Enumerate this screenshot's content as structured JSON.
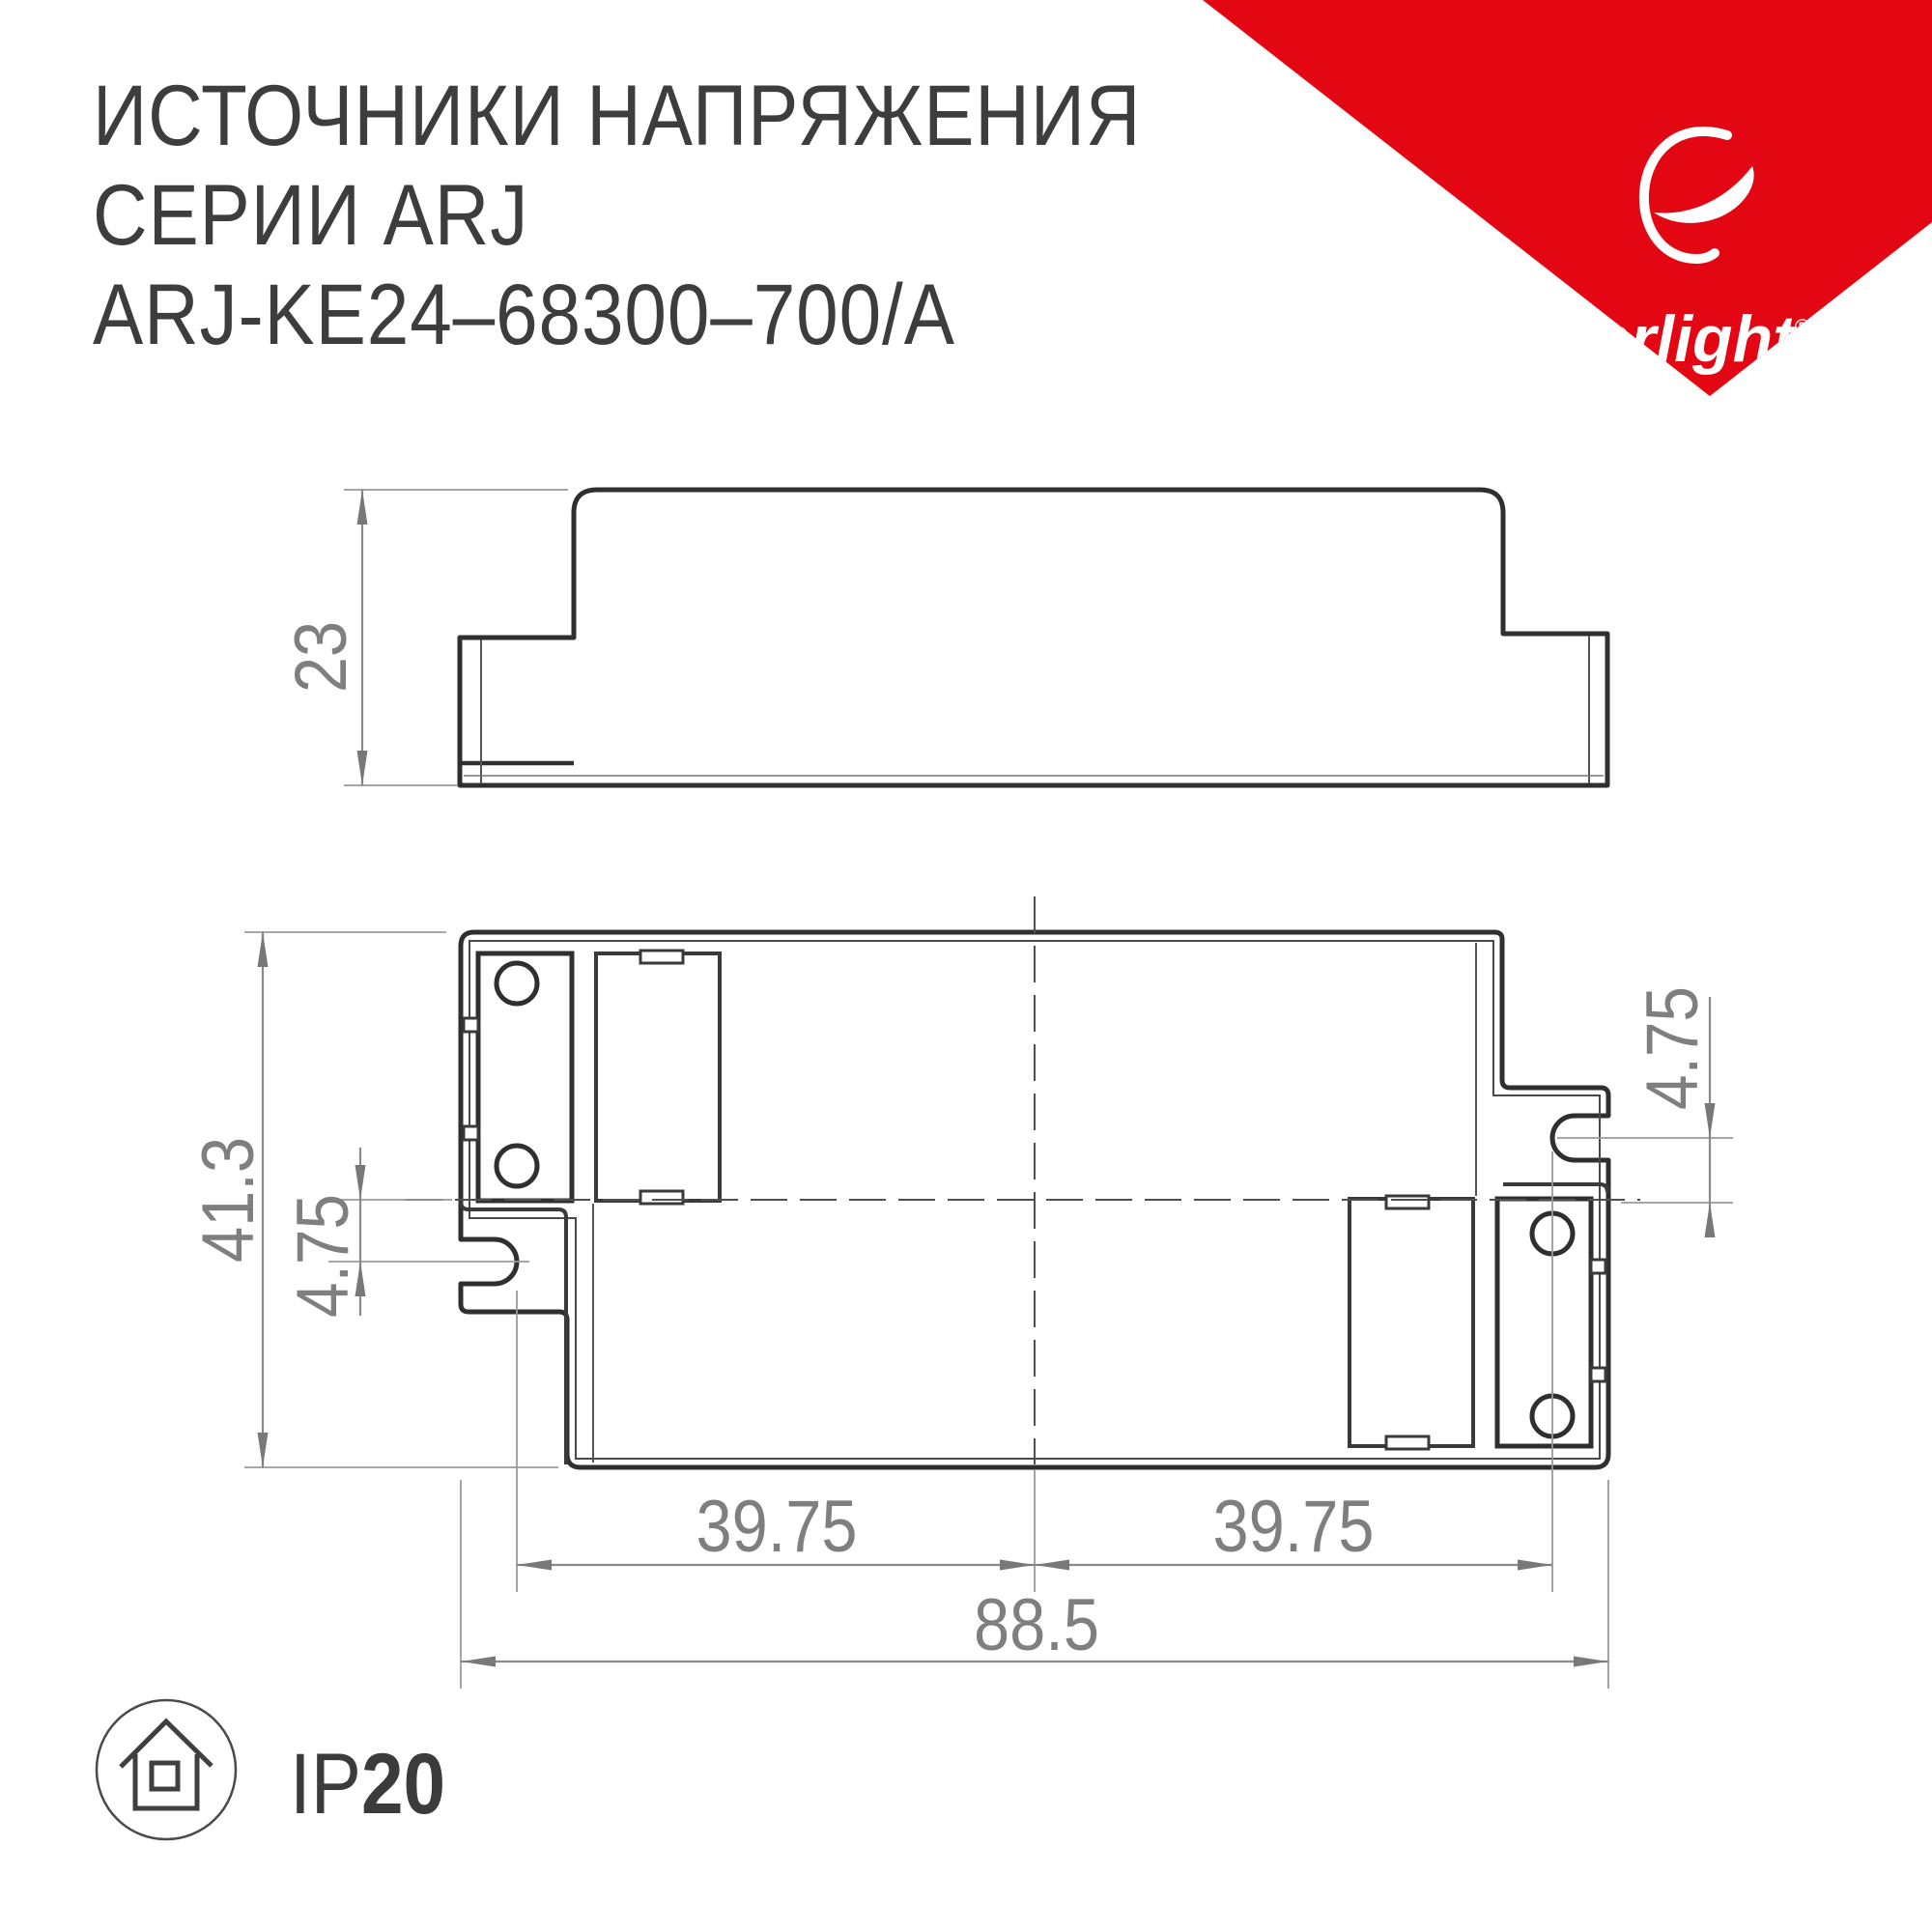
{
  "title": {
    "line1": "ИСТОЧНИКИ НАПРЯЖЕНИЯ",
    "line2": "СЕРИИ ARJ",
    "line3": "ARJ-KE24–68300–700/A"
  },
  "logo": {
    "brand": "arlight",
    "registered_mark": "®",
    "accent_color": "#E30613"
  },
  "drawing": {
    "type": "technical-dimension-drawing",
    "views": [
      "side-view",
      "plan-view"
    ],
    "dimensions": {
      "case_height_mm": "23",
      "case_depth_mm": "41.3",
      "slot_offset_left_mm": "4.75",
      "slot_offset_right_mm": "4.75",
      "hole_span_left_mm": "39.75",
      "hole_span_right_mm": "39.75",
      "total_length_mm": "88.5"
    }
  },
  "protection": {
    "prefix": "IP",
    "value": "20"
  }
}
